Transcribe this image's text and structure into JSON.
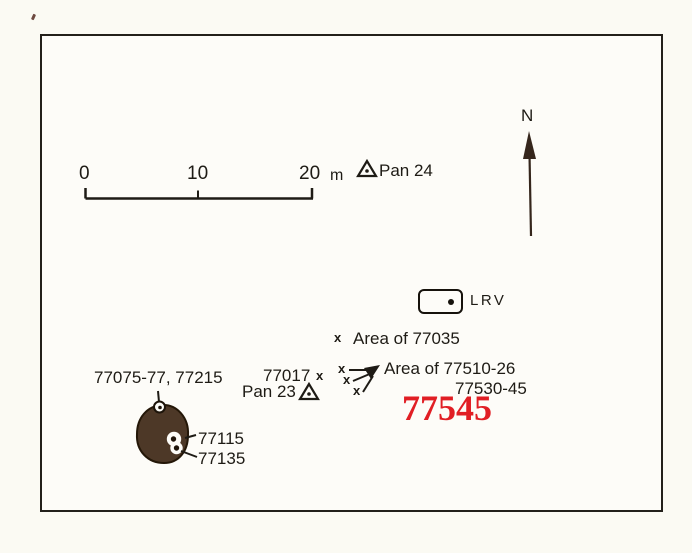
{
  "colors": {
    "paper": "#fbfaf3",
    "ink": "#1e1b15",
    "red": "#e11e24",
    "boulder_fill": "#4d3827",
    "boulder_edge": "#241708",
    "north_arrow": "#35261c"
  },
  "map": {
    "scale_bar": {
      "labels": [
        "0",
        "10",
        "20"
      ],
      "unit": "m"
    },
    "north_label": "N",
    "stations": {
      "pan24": "Pan 24",
      "pan23": "Pan 23"
    },
    "lrv_label": "LRV",
    "marker_x": "x",
    "labels": {
      "area_77035": "Area of 77035",
      "s77017": "77017",
      "area_77510_line1": "Area of 77510-26",
      "area_77510_line2": "77530-45",
      "highlight_77545": "77545",
      "boulder_group": "77075-77, 77215",
      "s77115": "77115",
      "s77135": "77135"
    }
  }
}
